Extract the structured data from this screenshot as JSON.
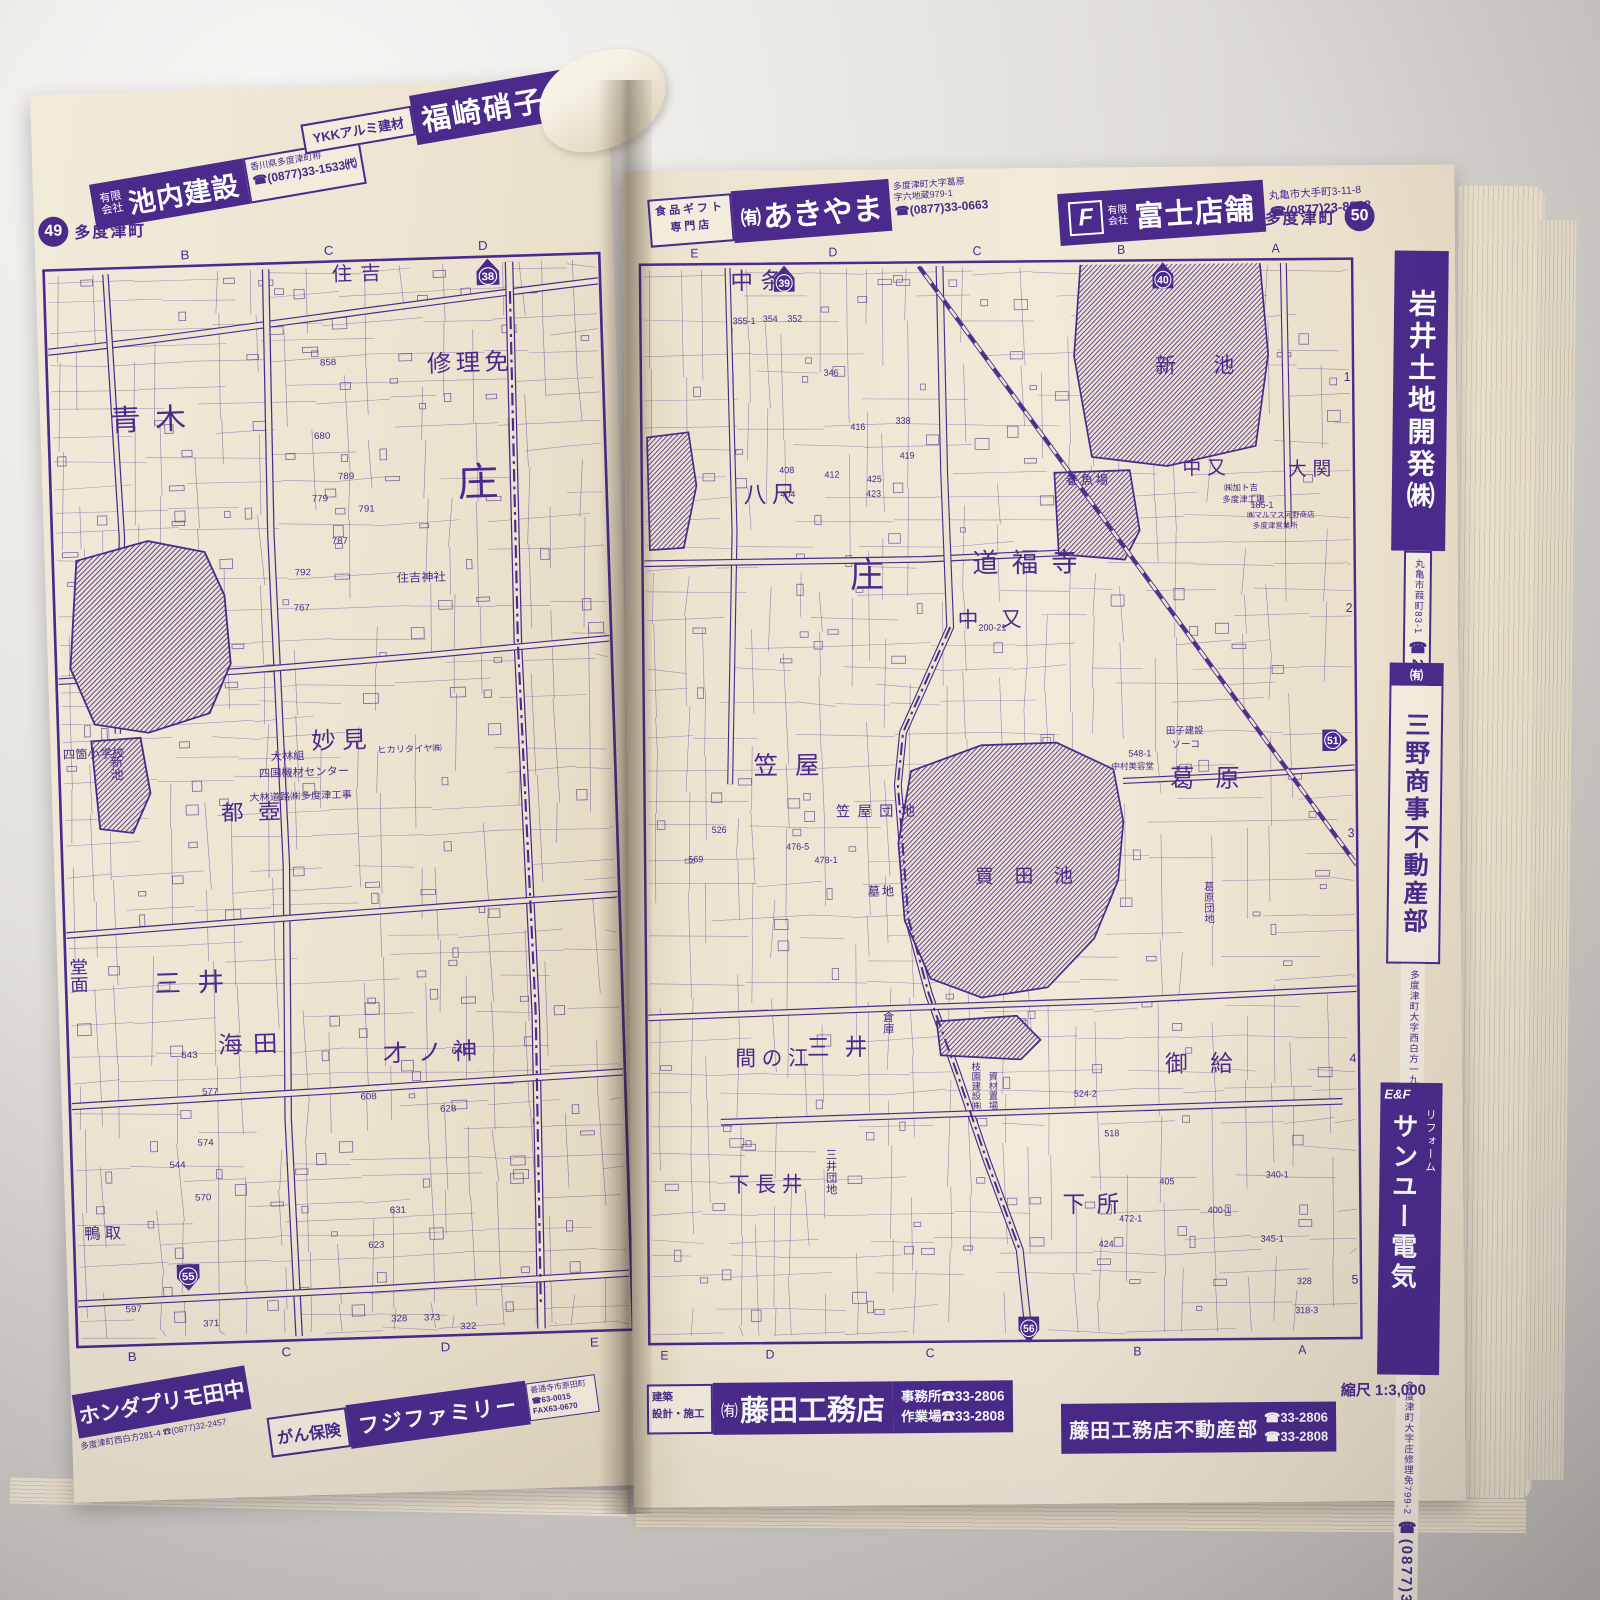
{
  "ink": "#4a2b8c",
  "paper": "#ece4d0",
  "left_page": {
    "page_number": "49",
    "town": "多度津町",
    "ads_top": {
      "ikeuchi": {
        "prefix": "有限会社",
        "name": "池内建設",
        "address": "香川県多度津町栫",
        "phone": "☎(0877)33-1533㈹"
      },
      "fukusaki": {
        "tagline": "YKKアルミ建材",
        "name": "福崎硝子店"
      }
    },
    "ads_bottom": {
      "honda": {
        "name": "ホンダプリモ田中",
        "address_phone": "多度津町西白方281-4 ☎(0877)32-2457"
      },
      "fujifamily": {
        "tagline": "がん保険",
        "name": "フジファミリー",
        "note": "善通寺市原田町",
        "phone": "☎63-0015",
        "fax": "FAX63-0670"
      }
    },
    "map": {
      "grid_top": [
        {
          "t": "B",
          "x": 140
        },
        {
          "t": "C",
          "x": 280
        },
        {
          "t": "D",
          "x": 430
        }
      ],
      "grid_bottom": [
        {
          "t": "B",
          "x": 55
        },
        {
          "t": "C",
          "x": 205
        },
        {
          "t": "D",
          "x": 360
        },
        {
          "t": "E",
          "x": 505
        }
      ],
      "rows_right": [],
      "shields": [
        {
          "n": "38",
          "x": 434,
          "y": 40,
          "dir": "up"
        },
        {
          "n": "55",
          "x": 112,
          "y": 1058,
          "dir": "down"
        }
      ],
      "labels": [
        {
          "t": "青木",
          "x": 62,
          "y": 190,
          "s": 30,
          "ls": 14
        },
        {
          "t": "庄",
          "x": 398,
          "y": 268,
          "s": 40
        },
        {
          "t": "修理免",
          "x": 372,
          "y": 140,
          "s": 24,
          "ls": 4
        },
        {
          "t": "住吉",
          "x": 282,
          "y": 44,
          "s": 20,
          "ls": 8
        },
        {
          "t": "妙見",
          "x": 248,
          "y": 522,
          "s": 24,
          "ls": 6
        },
        {
          "t": "都壺",
          "x": 158,
          "y": 592,
          "s": 22,
          "ls": 14
        },
        {
          "t": "三井",
          "x": 88,
          "y": 766,
          "s": 26,
          "ls": 16
        },
        {
          "t": "海田",
          "x": 148,
          "y": 830,
          "s": 24,
          "ls": 10
        },
        {
          "t": "才ノ神",
          "x": 308,
          "y": 844,
          "s": 24,
          "ls": 10
        },
        {
          "t": "堂面",
          "x": 14,
          "y": 728,
          "s": 18,
          "v": true
        },
        {
          "t": "鴨取",
          "x": 12,
          "y": 1016,
          "s": 16,
          "ls": 4
        },
        {
          "t": "新池",
          "x": 57,
          "y": 522,
          "s": 13,
          "v": true
        },
        {
          "t": "四箇小学校",
          "x": 6,
          "y": 524,
          "s": 12
        },
        {
          "t": "住吉神社",
          "x": 336,
          "y": 354,
          "s": 12
        },
        {
          "t": "大林組",
          "x": 208,
          "y": 532,
          "s": 11
        },
        {
          "t": "四国機材センター",
          "x": 196,
          "y": 549,
          "s": 11
        },
        {
          "t": "大林道路㈱多度津工事",
          "x": 186,
          "y": 573,
          "s": 10
        },
        {
          "t": "ヒカリタイヤ㈱",
          "x": 312,
          "y": 528,
          "s": 9
        }
      ],
      "numbers": [
        {
          "t": "858",
          "x": 268,
          "y": 130
        },
        {
          "t": "680",
          "x": 260,
          "y": 205
        },
        {
          "t": "789",
          "x": 282,
          "y": 247
        },
        {
          "t": "779",
          "x": 256,
          "y": 269
        },
        {
          "t": "791",
          "x": 301,
          "y": 281
        },
        {
          "t": "787",
          "x": 274,
          "y": 313
        },
        {
          "t": "792",
          "x": 237,
          "y": 344
        },
        {
          "t": "767",
          "x": 235,
          "y": 380
        },
        {
          "t": "543",
          "x": 112,
          "y": 834
        },
        {
          "t": "577",
          "x": 131,
          "y": 872
        },
        {
          "t": "574",
          "x": 125,
          "y": 924
        },
        {
          "t": "544",
          "x": 97,
          "y": 946
        },
        {
          "t": "570",
          "x": 121,
          "y": 980
        },
        {
          "t": "608",
          "x": 285,
          "y": 882
        },
        {
          "t": "641",
          "x": 375,
          "y": 838
        },
        {
          "t": "628",
          "x": 362,
          "y": 897
        },
        {
          "t": "631",
          "x": 310,
          "y": 999
        },
        {
          "t": "623",
          "x": 288,
          "y": 1034
        },
        {
          "t": "371",
          "x": 125,
          "y": 1109
        },
        {
          "t": "328",
          "x": 308,
          "y": 1110
        },
        {
          "t": "373",
          "x": 340,
          "y": 1110
        },
        {
          "t": "322",
          "x": 375,
          "y": 1120
        },
        {
          "t": "597",
          "x": 50,
          "y": 1092
        }
      ]
    }
  },
  "right_page": {
    "page_number": "50",
    "town": "多度津町",
    "ads_top": {
      "akiyama": {
        "tagline1": "食品ギフト",
        "tagline2": "専門店",
        "prefix": "㈲",
        "name": "あきやま",
        "address1": "多度津町大字葛原",
        "address2": "字六地蔵979-1",
        "phone": "☎(0877)33-0663"
      },
      "fujitempo": {
        "logo": "F",
        "prefix1": "有限",
        "prefix2": "会社",
        "name": "富士店舗",
        "address": "丸亀市大手町3-11-8",
        "phone": "☎(0877)23-8848"
      }
    },
    "sidebar_ads": {
      "iwai": {
        "name": "岩井土地開発㈱",
        "address": "丸亀市葭町83-1",
        "phone": "☎24-5101",
        "fax": "FAX24-5110"
      },
      "mino": {
        "prefix": "㈲",
        "name": "三野商事不動産部",
        "phone": "☎32-4115",
        "address": "多度津町大字西白方一九二一ー一"
      },
      "sanyu": {
        "logo": "E&F",
        "tagline": "リフォーム",
        "name": "サンユー電気",
        "phone": "☎(0877)33-1744",
        "address": "多度津町大字庄修理免799-2"
      }
    },
    "ads_bottom": {
      "fujita": {
        "tag1": "建築",
        "tag2": "設計・施工",
        "prefix": "㈲",
        "name": "藤田工務店",
        "office": "事務所☎33-2806",
        "workshop": "作業場☎33-2808"
      },
      "fujita_fudosan": {
        "name": "藤田工務店不動産部",
        "phone1": "☎33-2806",
        "phone2": "☎33-2808"
      },
      "scale_note": "縮尺 1:3,000"
    },
    "map": {
      "grid_top": [
        {
          "t": "E",
          "x": 60
        },
        {
          "t": "D",
          "x": 207
        },
        {
          "t": "C",
          "x": 360
        },
        {
          "t": "B",
          "x": 513
        },
        {
          "t": "A",
          "x": 677
        }
      ],
      "grid_bottom": [
        {
          "t": "E",
          "x": 18
        },
        {
          "t": "D",
          "x": 130
        },
        {
          "t": "C",
          "x": 300
        },
        {
          "t": "B",
          "x": 520
        },
        {
          "t": "A",
          "x": 695
        }
      ],
      "rows_right": [
        {
          "t": "1",
          "y": 150
        },
        {
          "t": "2",
          "y": 388
        },
        {
          "t": "3",
          "y": 620
        },
        {
          "t": "4",
          "y": 852
        },
        {
          "t": "5",
          "y": 1080
        }
      ],
      "shields": [
        {
          "n": "39",
          "x": 155,
          "y": 40,
          "dir": "up"
        },
        {
          "n": "40",
          "x": 557,
          "y": 40,
          "dir": "up"
        },
        {
          "n": "51",
          "x": 735,
          "y": 520,
          "dir": "right"
        },
        {
          "n": "56",
          "x": 405,
          "y": 1124,
          "dir": "down"
        }
      ],
      "labels": [
        {
          "t": "中条",
          "x": 98,
          "y": 50,
          "s": 24,
          "ls": 8
        },
        {
          "t": "八尺",
          "x": 110,
          "y": 270,
          "s": 24,
          "ls": 6
        },
        {
          "t": "庄",
          "x": 222,
          "y": 358,
          "s": 36
        },
        {
          "t": "道福寺",
          "x": 352,
          "y": 344,
          "s": 28,
          "ls": 14
        },
        {
          "t": "中又",
          "x": 336,
          "y": 400,
          "s": 22,
          "ls": 24
        },
        {
          "t": "新池",
          "x": 548,
          "y": 140,
          "s": 22,
          "ls": 40
        },
        {
          "t": "養魚場",
          "x": 452,
          "y": 254,
          "s": 13,
          "ls": 3
        },
        {
          "t": "中又",
          "x": 576,
          "y": 245,
          "s": 20,
          "ls": 6
        },
        {
          "t": "大関",
          "x": 688,
          "y": 247,
          "s": 20,
          "ls": 6
        },
        {
          "t": "葛原",
          "x": 560,
          "y": 567,
          "s": 26,
          "ls": 22
        },
        {
          "t": "笠屋",
          "x": 118,
          "y": 550,
          "s": 26,
          "ls": 18
        },
        {
          "t": "笠屋団地",
          "x": 205,
          "y": 594,
          "s": 15,
          "ls": 8
        },
        {
          "t": "買田池",
          "x": 352,
          "y": 664,
          "s": 20,
          "ls": 22
        },
        {
          "t": "墓地",
          "x": 238,
          "y": 676,
          "s": 13,
          "ls": 2
        },
        {
          "t": "間の江",
          "x": 96,
          "y": 850,
          "s": 22,
          "ls": 6
        },
        {
          "t": "三井",
          "x": 172,
          "y": 840,
          "s": 24,
          "ls": 16
        },
        {
          "t": "倉庫",
          "x": 258,
          "y": 795,
          "s": 12,
          "v": true
        },
        {
          "t": "三井団地",
          "x": 196,
          "y": 936,
          "s": 12,
          "v": true
        },
        {
          "t": "下長井",
          "x": 88,
          "y": 980,
          "s": 22,
          "ls": 6
        },
        {
          "t": "御給",
          "x": 552,
          "y": 860,
          "s": 24,
          "ls": 24
        },
        {
          "t": "下所",
          "x": 442,
          "y": 1004,
          "s": 24,
          "ls": 12
        },
        {
          "t": "枝園建設㈱",
          "x": 350,
          "y": 848,
          "s": 10,
          "v": true
        },
        {
          "t": "資材置場",
          "x": 368,
          "y": 858,
          "s": 10,
          "v": true
        },
        {
          "t": "葛原団地",
          "x": 600,
          "y": 664,
          "s": 11,
          "v": true
        },
        {
          "t": "田子建設",
          "x": 556,
          "y": 512,
          "s": 10
        },
        {
          "t": "ソーコ",
          "x": 562,
          "y": 526,
          "s": 10
        },
        {
          "t": "㈱加ト吉",
          "x": 620,
          "y": 262,
          "s": 9
        },
        {
          "t": "多度津工場",
          "x": 618,
          "y": 274,
          "s": 9
        },
        {
          "t": "㈱マルマス河野商店",
          "x": 644,
          "y": 290,
          "s": 8
        },
        {
          "t": "多度津営業所",
          "x": 650,
          "y": 301,
          "s": 8
        },
        {
          "t": "中村美容堂",
          "x": 498,
          "y": 548,
          "s": 9
        }
      ],
      "numbers": [
        {
          "t": "355-1",
          "x": 100,
          "y": 86
        },
        {
          "t": "354",
          "x": 132,
          "y": 84
        },
        {
          "t": "352",
          "x": 158,
          "y": 84
        },
        {
          "t": "346",
          "x": 196,
          "y": 140
        },
        {
          "t": "338",
          "x": 272,
          "y": 190
        },
        {
          "t": "416",
          "x": 224,
          "y": 196
        },
        {
          "t": "419",
          "x": 276,
          "y": 226
        },
        {
          "t": "408",
          "x": 148,
          "y": 240
        },
        {
          "t": "404",
          "x": 149,
          "y": 265
        },
        {
          "t": "412",
          "x": 196,
          "y": 245
        },
        {
          "t": "425",
          "x": 241,
          "y": 250
        },
        {
          "t": "423",
          "x": 240,
          "y": 265
        },
        {
          "t": "200-21",
          "x": 358,
          "y": 404
        },
        {
          "t": "548-1",
          "x": 516,
          "y": 535
        },
        {
          "t": "185-1",
          "x": 648,
          "y": 280
        },
        {
          "t": "526",
          "x": 73,
          "y": 610
        },
        {
          "t": "569",
          "x": 48,
          "y": 640
        },
        {
          "t": "476-5",
          "x": 152,
          "y": 628
        },
        {
          "t": "478-1",
          "x": 182,
          "y": 642
        },
        {
          "t": "518",
          "x": 487,
          "y": 926
        },
        {
          "t": "524-2",
          "x": 455,
          "y": 885
        },
        {
          "t": "405",
          "x": 545,
          "y": 976
        },
        {
          "t": "400-1",
          "x": 596,
          "y": 1006
        },
        {
          "t": "340-1",
          "x": 658,
          "y": 970
        },
        {
          "t": "472-1",
          "x": 502,
          "y": 1014
        },
        {
          "t": "424",
          "x": 480,
          "y": 1040
        },
        {
          "t": "345-1",
          "x": 652,
          "y": 1036
        },
        {
          "t": "328",
          "x": 690,
          "y": 1080
        },
        {
          "t": "318-3",
          "x": 688,
          "y": 1110
        }
      ]
    }
  }
}
